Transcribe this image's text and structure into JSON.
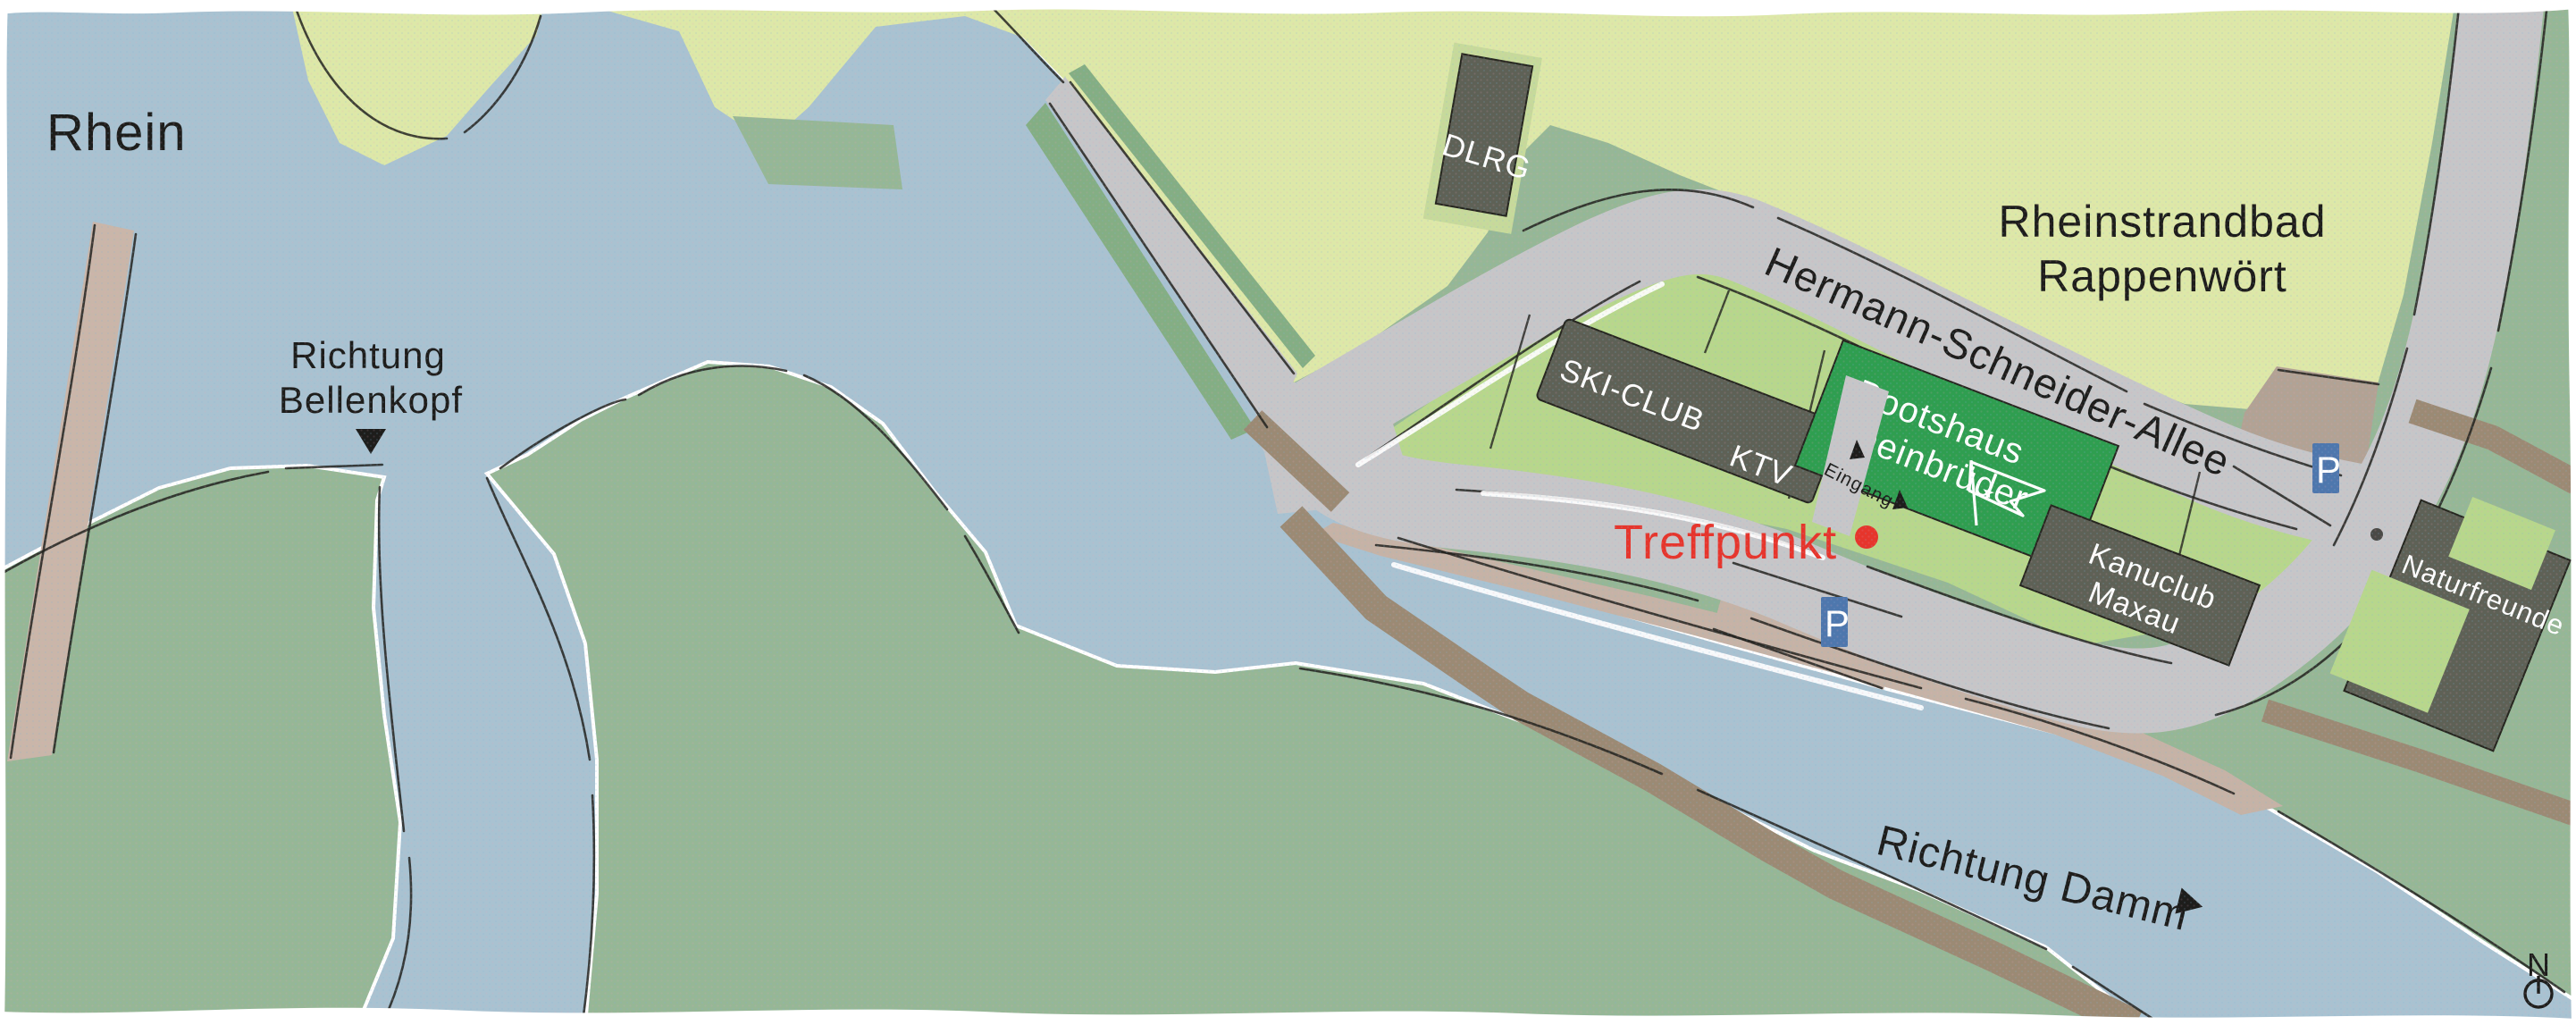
{
  "map_title": "Anfahrtsskizze Bootshaus Rheinbrüder",
  "colors": {
    "water": "#a9c2d1",
    "land": "#96b796",
    "sand": "#dde8a8",
    "parcel": "#b7d78c",
    "clubgreen": "#2f9e50",
    "building": "#5e6156",
    "road": "#c6c6c8",
    "lot": "#b2a294",
    "bank": "#c5b3a6",
    "trail": "#9b8a74",
    "flank": "#84ae84",
    "ink": "#1d1d1b",
    "red": "#e6352c",
    "pblue": "#4e77ad"
  },
  "water_labels": {
    "rhein": "Rhein",
    "bellenkopf_line1": "Richtung",
    "bellenkopf_line2": "Bellenkopf",
    "damm": "Richtung Damm"
  },
  "road_labels": {
    "hermann_schneider_allee": "Hermann-Schneider-Allee"
  },
  "area_labels": {
    "rheinstrandbad_line1": "Rheinstrandbad",
    "rheinstrandbad_line2": "Rappenwört"
  },
  "buildings": {
    "dlrg": "DLRG",
    "skiclub": "SKI-CLUB",
    "ktv": "KTV",
    "bootshaus_line1": "Bootshaus",
    "bootshaus_line2": "Rheinbrüder",
    "kanuclub_line1": "Kanuclub",
    "kanuclub_line2": "Maxau",
    "naturfreunde": "Naturfreunde"
  },
  "markers": {
    "treffpunkt": "Treffpunkt",
    "eingang": "Eingang",
    "parking": "P",
    "north": "N"
  },
  "icons": {
    "club_flag_star": "★"
  }
}
